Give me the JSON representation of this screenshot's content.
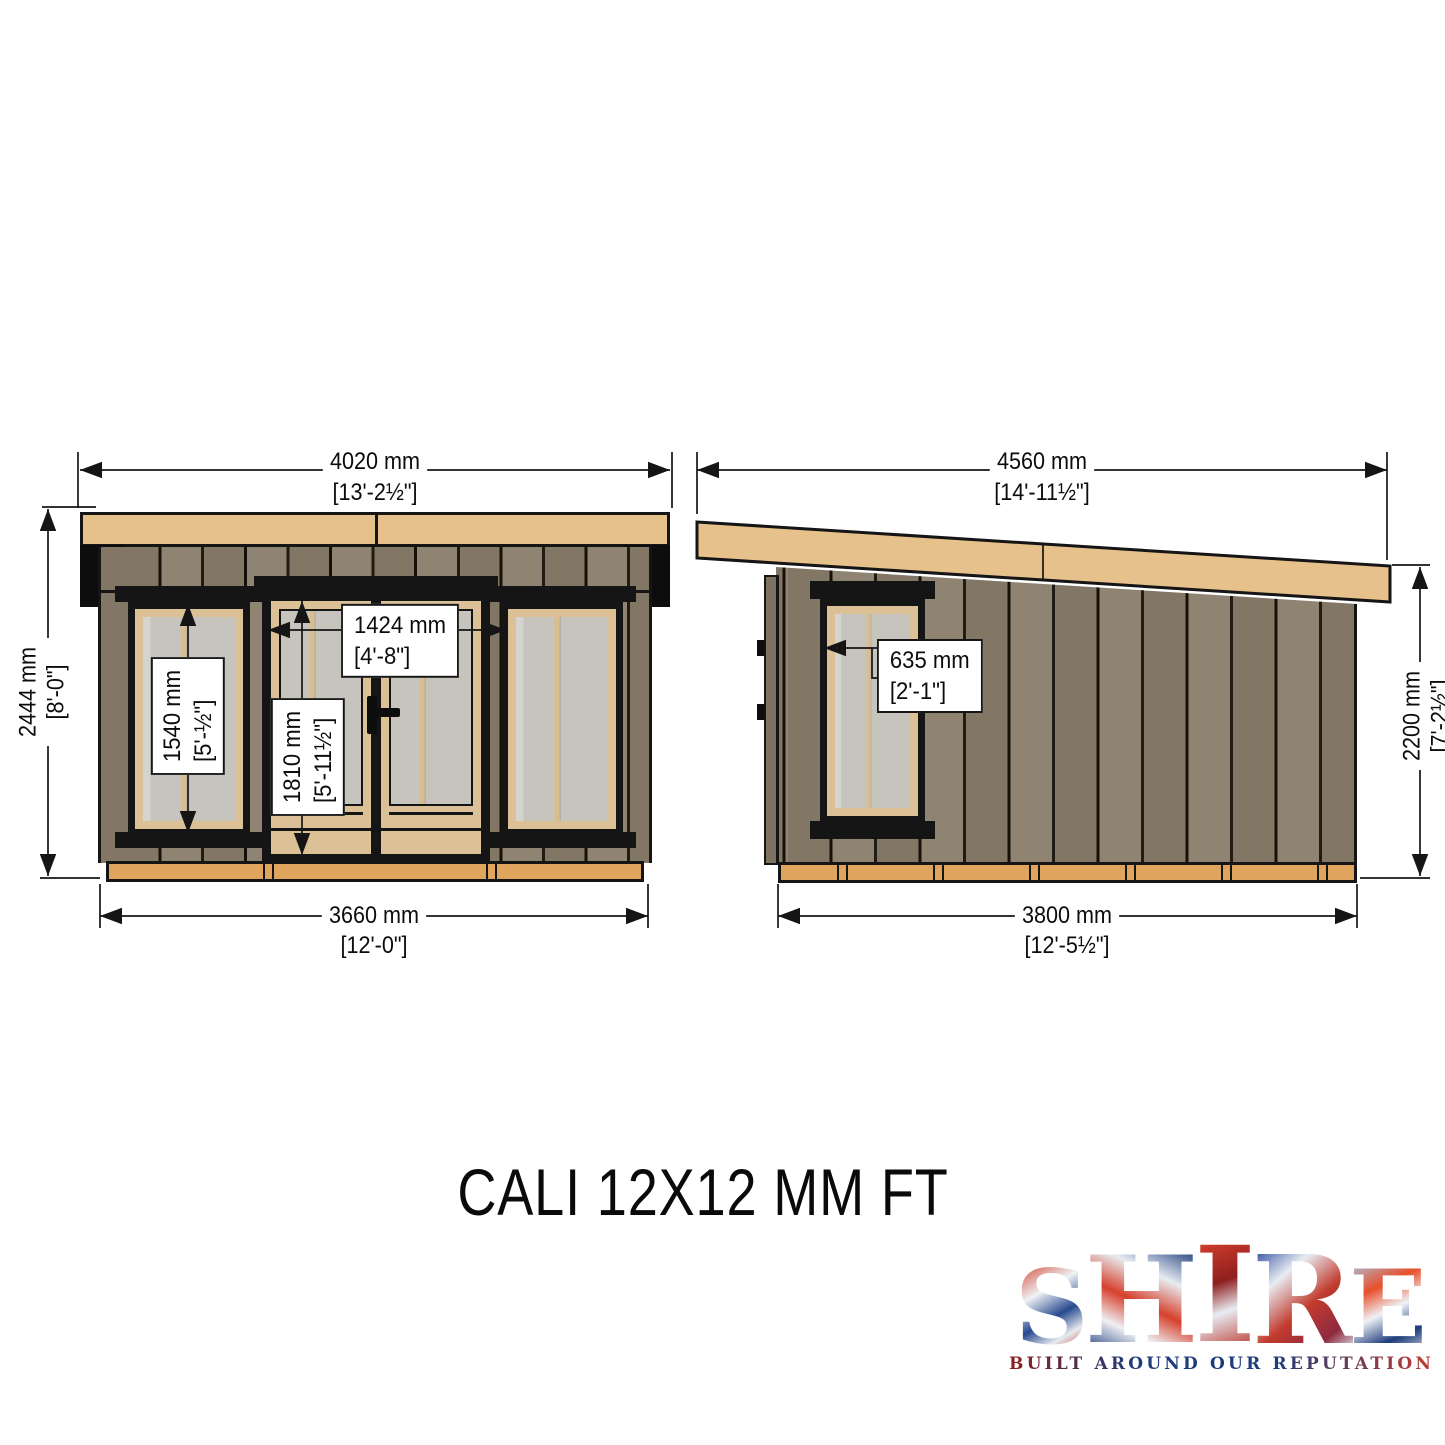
{
  "title": "CALI 12X12 MM FT",
  "views": {
    "front": {
      "overall_width": {
        "mm": "4020 mm",
        "ft": "[13'-2½\"]"
      },
      "overall_height": {
        "mm": "2444 mm",
        "ft": "[8'-0\"]"
      },
      "base_width": {
        "mm": "3660 mm",
        "ft": "[12'-0\"]"
      },
      "door_width": {
        "mm": "1424 mm",
        "ft": "[4'-8\"]"
      },
      "door_height": {
        "mm": "1810 mm",
        "ft": "[5'-11½\"]"
      },
      "window_height": {
        "mm": "1540 mm",
        "ft": "[5'-½\"]"
      }
    },
    "side": {
      "overall_width": {
        "mm": "4560 mm",
        "ft": "[14'-11½\"]"
      },
      "wall_height": {
        "mm": "2200 mm",
        "ft": "[7'-2½\"]"
      },
      "base_width": {
        "mm": "3800 mm",
        "ft": "[12'-5½\"]"
      },
      "window_width": {
        "mm": "635 mm",
        "ft": "[2'-1\"]"
      }
    }
  },
  "logo": {
    "letters": [
      "S",
      "H",
      "I",
      "R",
      "E"
    ],
    "tagline": "BUILT AROUND OUR REPUTATION"
  },
  "colors": {
    "fascia": "#e7c18c",
    "wall": "#8a7d6b",
    "base": "#dfa55c",
    "frame_wood": "#dcc096",
    "glass": "#c7c4bd",
    "line": "#151515",
    "logo_red": "#c23b2e",
    "logo_blue": "#1e3f7f"
  }
}
